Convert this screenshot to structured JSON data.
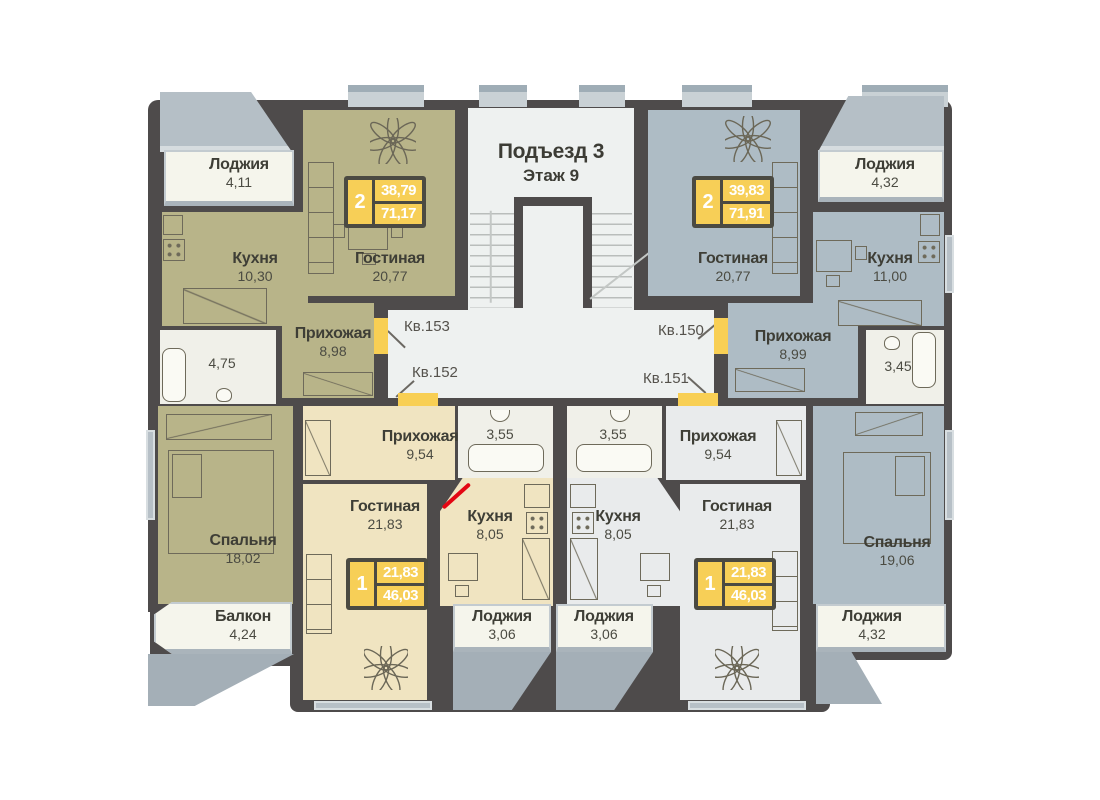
{
  "title": {
    "entrance": "Подъезд 3",
    "floor": "Этаж 9"
  },
  "apartments": [
    {
      "number": "Кв.153",
      "rooms_badge": "2",
      "living_area": "38,79",
      "total_area": "71,17",
      "fill": "#b8b489",
      "rooms": [
        {
          "name": "Лоджия",
          "area": "4,11"
        },
        {
          "name": "Кухня",
          "area": "10,30"
        },
        {
          "name": "Гостиная",
          "area": "20,77"
        },
        {
          "name": "Прихожая",
          "area": "8,98"
        },
        {
          "name": "",
          "area": "4,75"
        },
        {
          "name": "Спальня",
          "area": "18,02"
        },
        {
          "name": "Балкон",
          "area": "4,24"
        }
      ]
    },
    {
      "number": "Кв.150",
      "rooms_badge": "2",
      "living_area": "39,83",
      "total_area": "71,91",
      "fill": "#aebcc5",
      "rooms": [
        {
          "name": "Лоджия",
          "area": "4,32"
        },
        {
          "name": "Гостиная",
          "area": "20,77"
        },
        {
          "name": "Кухня",
          "area": "11,00"
        },
        {
          "name": "Прихожая",
          "area": "8,99"
        },
        {
          "name": "",
          "area": "3,45"
        },
        {
          "name": "Спальня",
          "area": "19,06"
        },
        {
          "name": "Лоджия",
          "area": "4,32"
        }
      ]
    },
    {
      "number": "Кв.152",
      "rooms_badge": "1",
      "living_area": "21,83",
      "total_area": "46,03",
      "fill": "#f0e4c1",
      "rooms": [
        {
          "name": "Прихожая",
          "area": "9,54"
        },
        {
          "name": "",
          "area": "3,55"
        },
        {
          "name": "Гостиная",
          "area": "21,83"
        },
        {
          "name": "Кухня",
          "area": "8,05"
        },
        {
          "name": "Лоджия",
          "area": "3,06"
        }
      ]
    },
    {
      "number": "Кв.151",
      "rooms_badge": "1",
      "living_area": "21,83",
      "total_area": "46,03",
      "fill": "#e9ebec",
      "rooms": [
        {
          "name": "",
          "area": "3,55"
        },
        {
          "name": "Прихожая",
          "area": "9,54"
        },
        {
          "name": "Кухня",
          "area": "8,05"
        },
        {
          "name": "Гостиная",
          "area": "21,83"
        },
        {
          "name": "Лоджия",
          "area": "3,06"
        }
      ]
    }
  ],
  "colors": {
    "wall": "#4e4b4b",
    "apartment_olive": "#b8b489",
    "apartment_blue": "#aebcc5",
    "apartment_cream": "#f0e4c1",
    "apartment_gray": "#e9ebec",
    "corridor": "#eef1f0",
    "loggia": "#f5f5ec",
    "door_marker": "#f8cf54",
    "badge_yellow": "#f7cf57",
    "badge_frame": "#4b4a42",
    "entry_door_red": "#e30613",
    "window": "#b7c0c7",
    "shadow": "#a4afb7"
  }
}
